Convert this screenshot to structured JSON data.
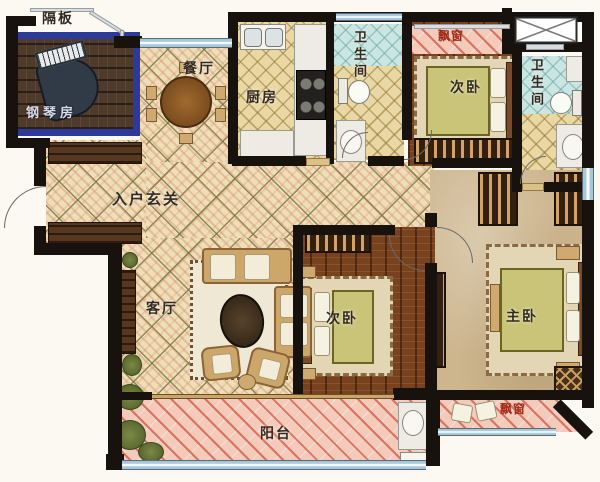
{
  "floorplan": {
    "labels": {
      "partition": "隔板",
      "piano_room": "钢琴房",
      "dining_room": "餐厅",
      "kitchen": "厨房",
      "bathroom_1": "卫生间",
      "bathroom_2": "卫生间",
      "bay_window_top": "飘窗",
      "bedroom_second_top": "次卧",
      "entry_foyer": "入户玄关",
      "living_room": "客厅",
      "bedroom_second_mid": "次卧",
      "master_bedroom": "主卧",
      "balcony": "阳台",
      "bay_window_bottom": "飘窗"
    },
    "colors": {
      "wall": "#17120d",
      "piano_room_border": "#2c3a9c",
      "window_glass": "#a6c8dc",
      "floor_tile": "#eedfb9",
      "wood_floor": "#78421f",
      "master_floor": "#cdb58e",
      "balcony_pink": "#f4cabb",
      "shower_tile": "#c9e6e2"
    }
  }
}
